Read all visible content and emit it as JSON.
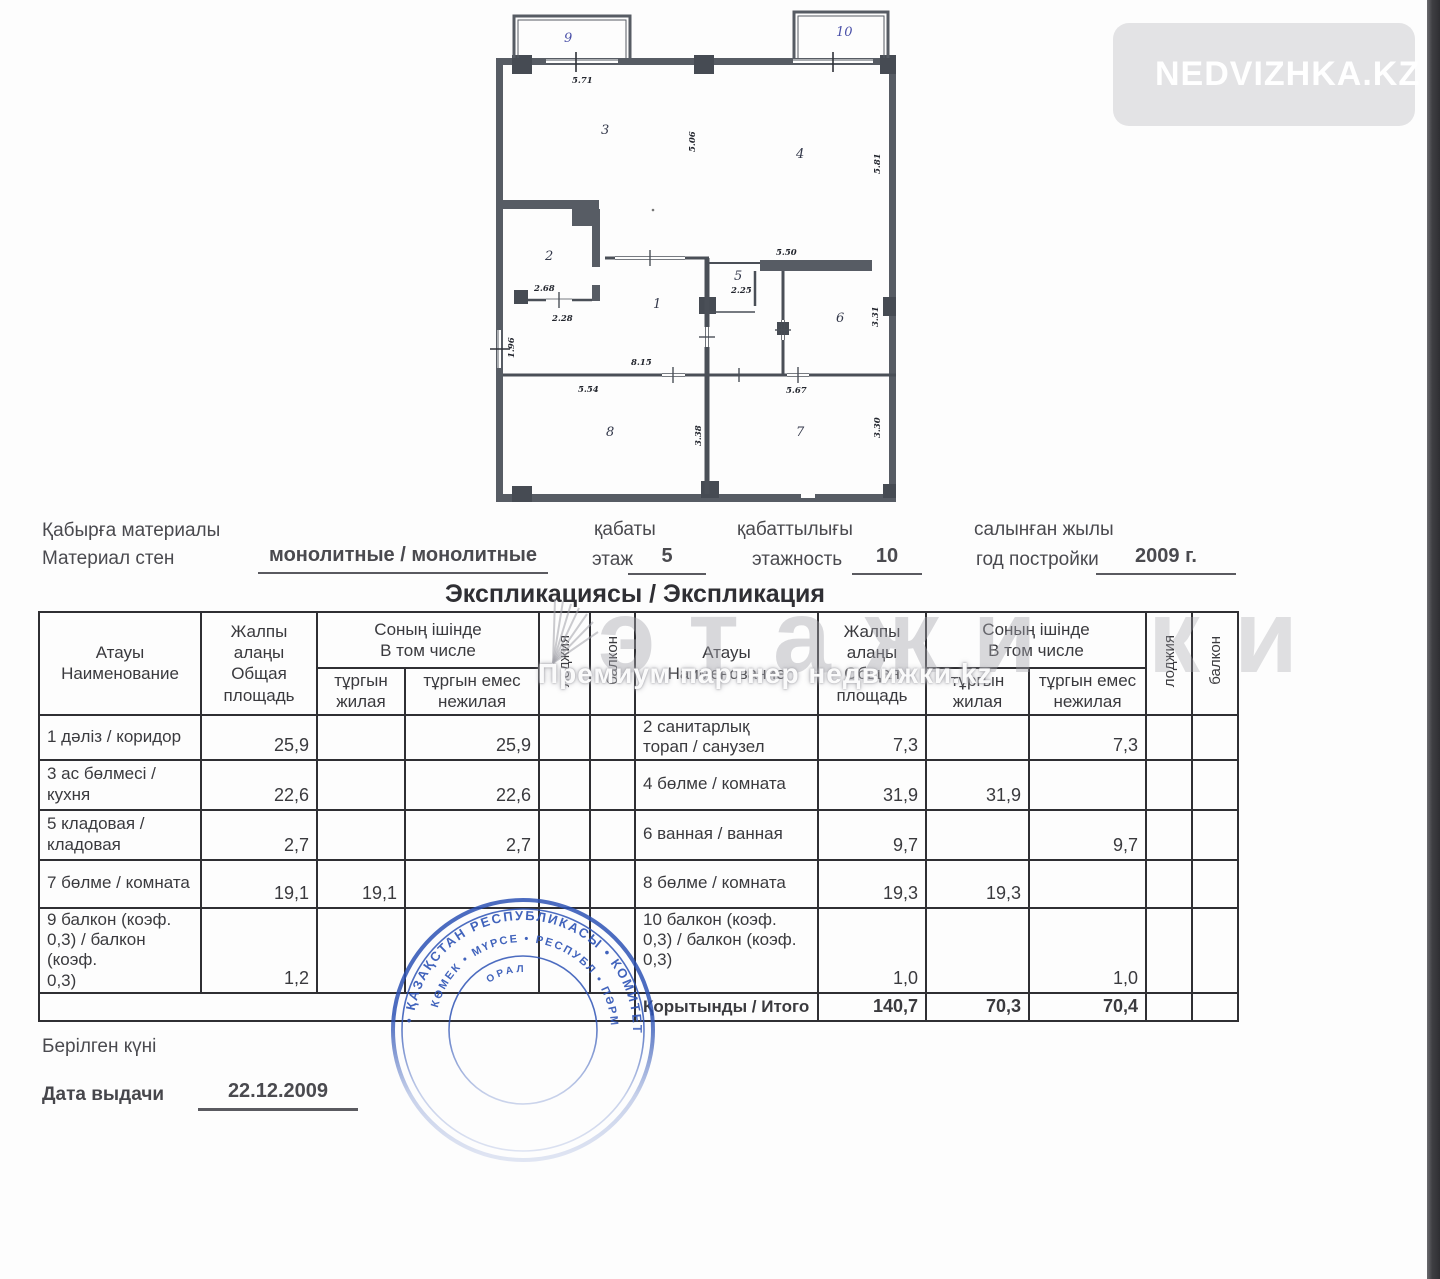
{
  "logo": {
    "text": "NEDVIZHKA.KZ"
  },
  "plan": {
    "rooms": {
      "r1": "1",
      "r2": "2",
      "r3": "3",
      "r4": "4",
      "r5": "5",
      "r6": "6",
      "r7": "7",
      "r8": "8",
      "r9": "9",
      "r10": "10"
    },
    "dims": {
      "d571": "5.71",
      "d506": "5.06",
      "d581": "5.81",
      "d550": "5.50",
      "d225": "2.25",
      "d331": "3.31",
      "d268": "2.68",
      "d228": "2.28",
      "d196": "1.96",
      "d815": "8.15",
      "d554": "5.54",
      "d567": "5.67",
      "d338": "3.38",
      "d330": "3.30"
    }
  },
  "info": {
    "wall_label_kk": "Қабырға материалы",
    "wall_label_ru": "Материал стен",
    "wall_value": "монолитные / монолитные",
    "floor_label_kk": "қабаты",
    "floor_label_ru": "этаж",
    "floor_value": "5",
    "storeys_label_kk": "қабаттылығы",
    "storeys_label_ru": "этажность",
    "storeys_value": "10",
    "year_label_kk": "салынған жылы",
    "year_label_ru": "год постройки",
    "year_value": "2009 г."
  },
  "table": {
    "title": "Экспликациясы / Экспликация",
    "header": {
      "name": "Атауы\nНаименование",
      "total": "Жалпы\nалаңы\nОбщая\nплощадь",
      "including": "Соның ішінде\nВ том числе",
      "living": "тұргын\nжилая",
      "nonliving": "тұргын емес\nнежилая",
      "loggia": "лоджия",
      "balcony": "балкон"
    },
    "left_rows": [
      {
        "name": "1 дәліз / коридор",
        "total": "25,9",
        "living": "",
        "nonliving": "25,9"
      },
      {
        "name": "3 ас бөлмесі /\nкухня",
        "total": "22,6",
        "living": "",
        "nonliving": "22,6"
      },
      {
        "name": "5 кладовая /\nкладовая",
        "total": "2,7",
        "living": "",
        "nonliving": "2,7"
      },
      {
        "name": "7 бөлме / комната",
        "total": "19,1",
        "living": "19,1",
        "nonliving": ""
      },
      {
        "name": "9 балкон (коэф.\n0,3) / балкон (коэф.\n0,3)",
        "total": "1,2",
        "living": "",
        "nonliving": ""
      }
    ],
    "right_rows": [
      {
        "name": "2 санитарлық\nторап / санузел",
        "total": "7,3",
        "living": "",
        "nonliving": "7,3"
      },
      {
        "name": "4 бөлме / комната",
        "total": "31,9",
        "living": "31,9",
        "nonliving": ""
      },
      {
        "name": "6 ванная / ванная",
        "total": "9,7",
        "living": "",
        "nonliving": "9,7"
      },
      {
        "name": "8 бөлме / комната",
        "total": "19,3",
        "living": "19,3",
        "nonliving": ""
      },
      {
        "name": "10 балкон (коэф.\n0,3) / балкон (коэф.\n0,3)",
        "total": "1,0",
        "living": "",
        "nonliving": "1,0"
      }
    ],
    "total_row": {
      "name": "Қорытынды / Итого",
      "total": "140,7",
      "living": "70,3",
      "nonliving": "70,4"
    }
  },
  "watermark": {
    "brand": "этажи",
    "brand_tail": "ки",
    "subtitle": "Премиум партнер недвижки.kz"
  },
  "stamp": {
    "ring_outer": "• ҚАЗАҚСТАН РЕСПУБЛИКАСЫ • КОМИТЕТІНІҢ",
    "ring_inner": "КӨМЕК • МҮРСЕ • РЕСПУБЛ • ПӘРМ",
    "ring_center": "ОРАЛ"
  },
  "issue": {
    "label_kk": "Берілген күні",
    "label_ru": "Дата выдачи",
    "date": "22.12.2009"
  }
}
